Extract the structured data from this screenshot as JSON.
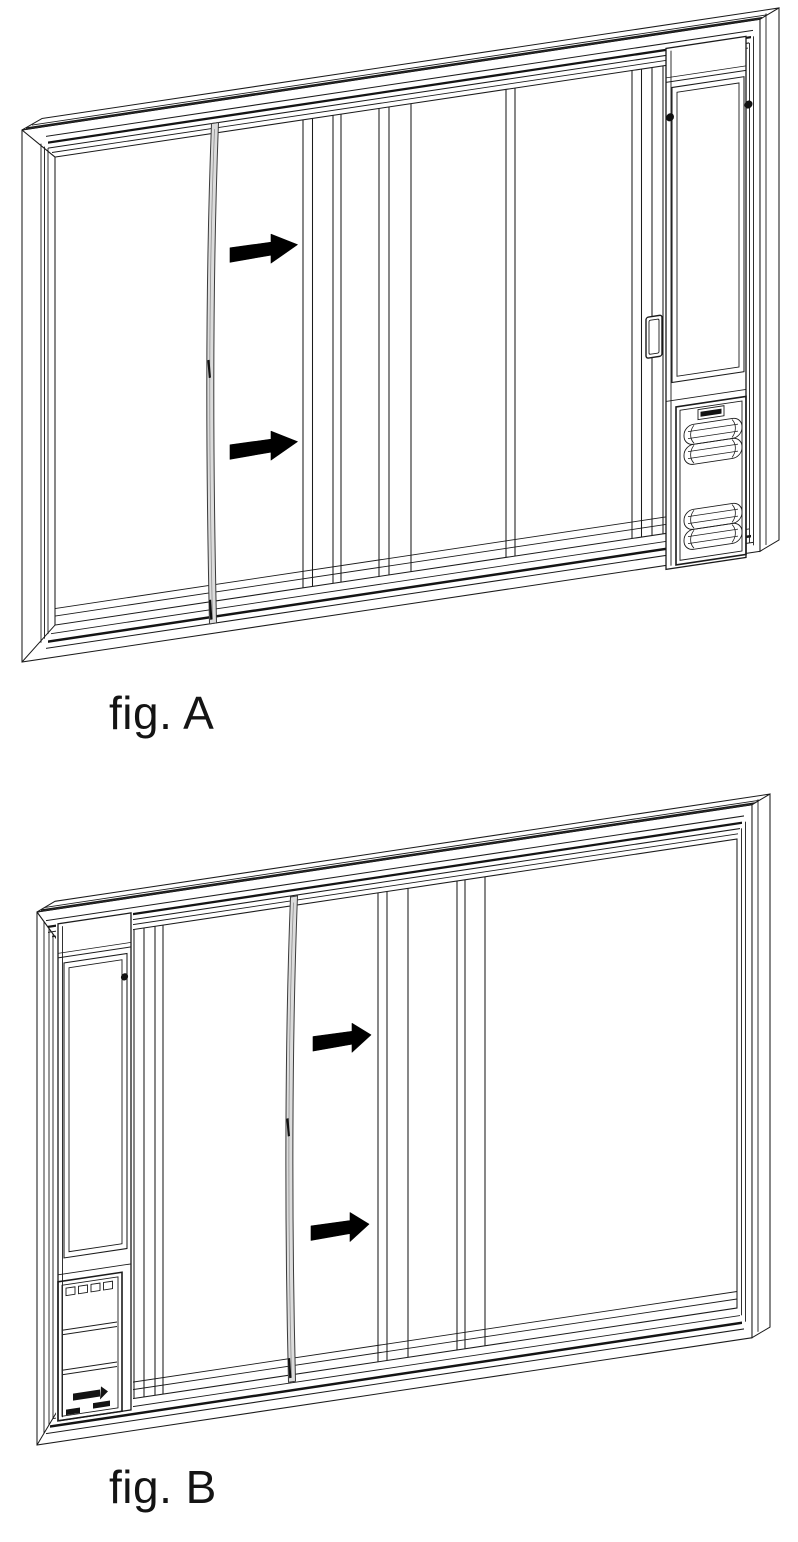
{
  "page": {
    "type": "instruction-diagram",
    "background": "#ffffff"
  },
  "figures": [
    {
      "id": "A",
      "label": "fig. A",
      "pet_door_side": "right",
      "arrow_count": 2
    },
    {
      "id": "B",
      "label": "fig. B",
      "pet_door_side": "left",
      "arrow_count": 2
    }
  ],
  "colors": {
    "line": "#1b1b1b",
    "arrow": "#000000",
    "weather_strip": "#dcdcdc",
    "screw": "#111111",
    "background": "#ffffff"
  }
}
